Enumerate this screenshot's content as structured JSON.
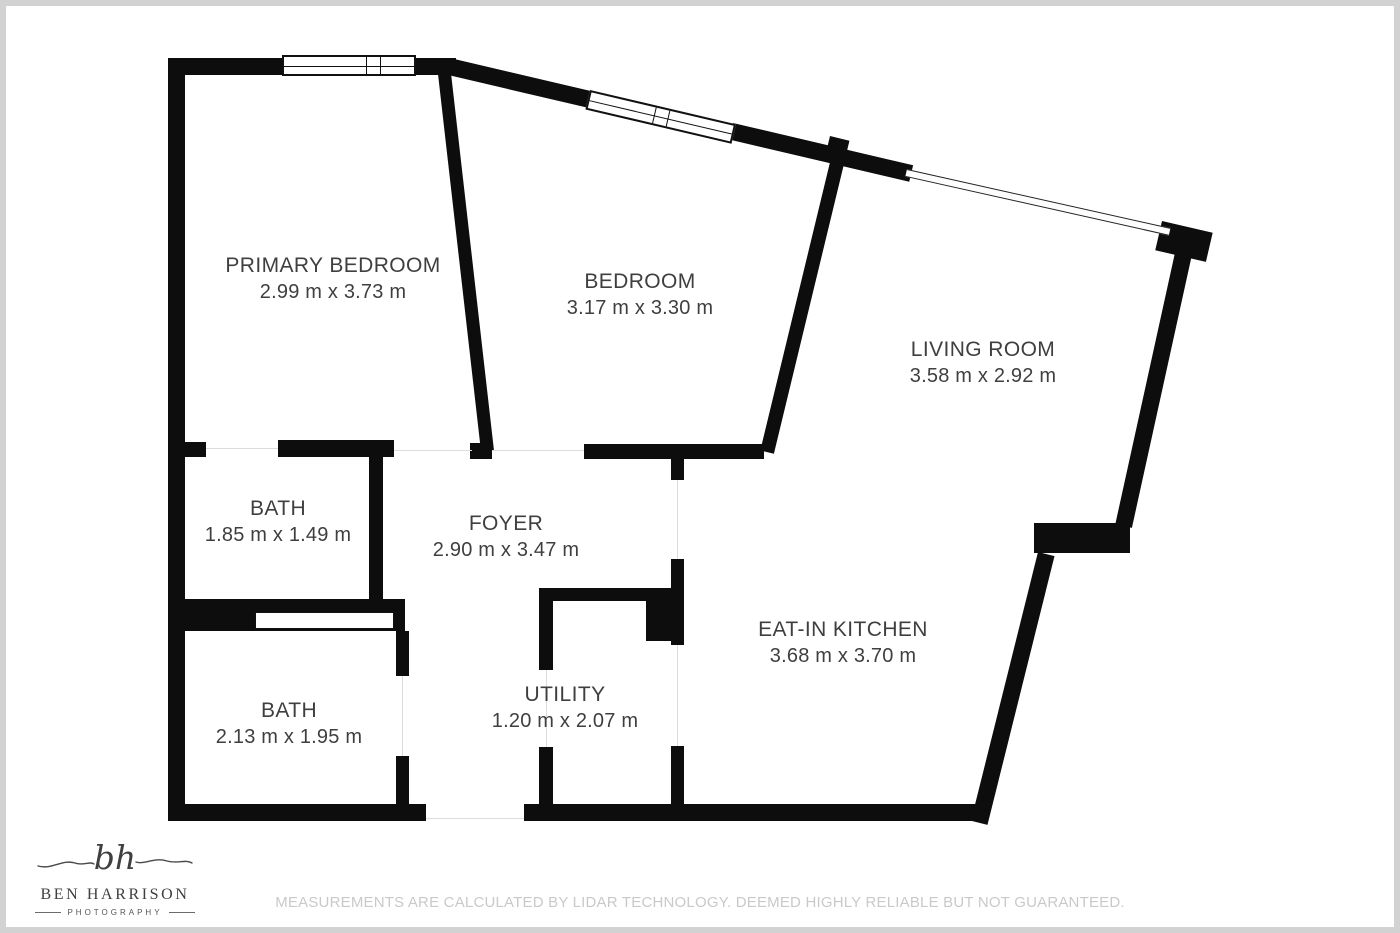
{
  "rooms": {
    "primary_bedroom": {
      "name": "PRIMARY BEDROOM",
      "dims": "2.99 m x 3.73 m"
    },
    "bedroom": {
      "name": "BEDROOM",
      "dims": "3.17 m x 3.30 m"
    },
    "living_room": {
      "name": "LIVING ROOM",
      "dims": "3.58 m x 2.92 m"
    },
    "bath_top": {
      "name": "BATH",
      "dims": "1.85 m x 1.49 m"
    },
    "foyer": {
      "name": "FOYER",
      "dims": "2.90 m x 3.47 m"
    },
    "bath_bottom": {
      "name": "BATH",
      "dims": "2.13 m x 1.95 m"
    },
    "utility": {
      "name": "UTILITY",
      "dims": "1.20 m x 2.07 m"
    },
    "kitchen": {
      "name": "EAT-IN KITCHEN",
      "dims": "3.68 m x 3.70 m"
    }
  },
  "footer": {
    "logo": {
      "monogram": "bh",
      "name": "BEN HARRISON",
      "tagline": "PHOTOGRAPHY"
    },
    "disclaimer": "MEASUREMENTS ARE CALCULATED BY LIDAR TECHNOLOGY. DEEMED HIGHLY RELIABLE BUT NOT GUARANTEED."
  },
  "colors": {
    "wall": "#0d0d0d",
    "room_label": "#3f3f3f",
    "disclaimer_text": "#c9c9c9",
    "frame": "#d2d2d2",
    "logo_text": "#3f3f3f"
  }
}
